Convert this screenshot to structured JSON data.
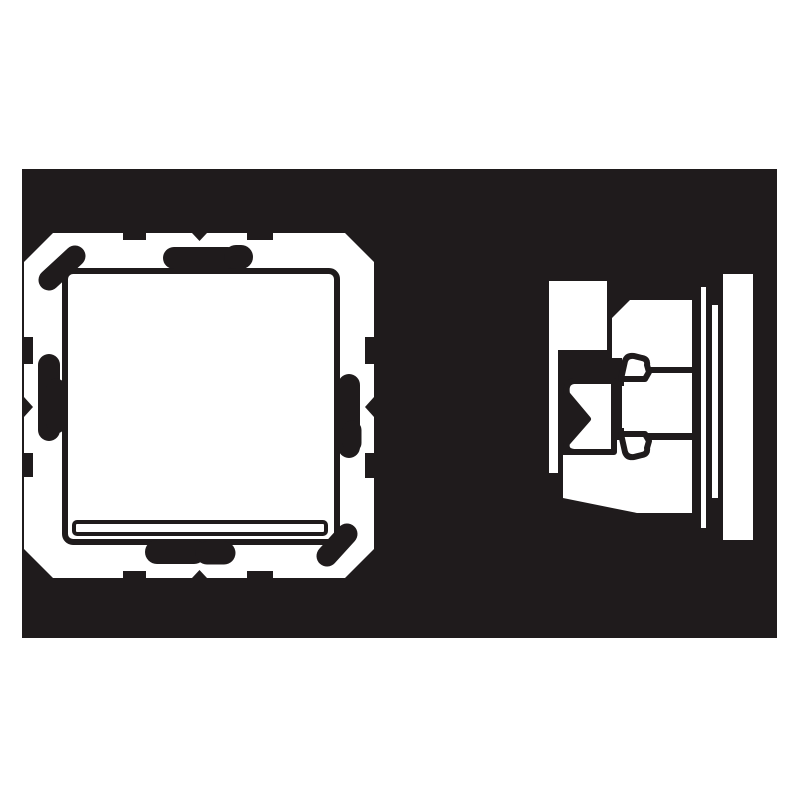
{
  "figure": {
    "kind": "technical-line-drawing",
    "subject": "rocker-wall-switch",
    "views": [
      {
        "id": "front-view",
        "parts": [
          "mounting-plate",
          "edge-notches",
          "claw-marks",
          "rocker-button",
          "label-window"
        ]
      },
      {
        "id": "side-view",
        "parts": [
          "rocker-profile",
          "switch-insert-body",
          "claw-mechanism",
          "gap-strips",
          "wall-frame-profile"
        ]
      }
    ]
  },
  "colors": {
    "page-bg": "#ffffff",
    "panel-bg": "#1f1b1c",
    "drawing-fill": "#ffffff",
    "drawing-line": "#1f1b1c"
  }
}
